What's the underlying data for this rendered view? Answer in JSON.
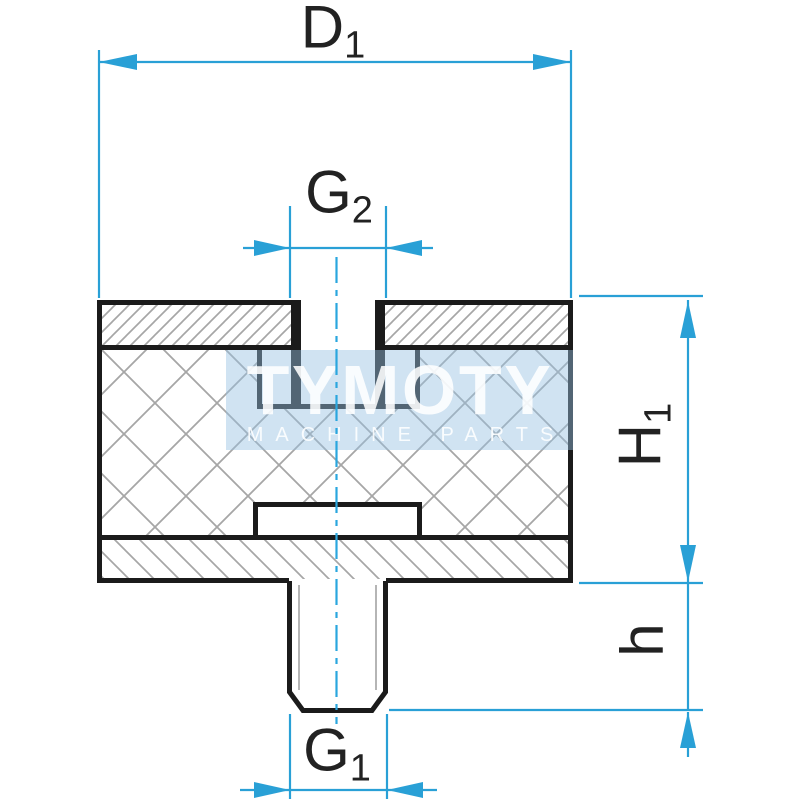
{
  "drawing": {
    "type": "technical-section-drawing",
    "part": "rubber-metal vibration mount, type plate-thread / plate-stud",
    "labels": {
      "d1": {
        "main": "D",
        "sub": "1"
      },
      "g2": {
        "main": "G",
        "sub": "2"
      },
      "h1": {
        "main": "H",
        "sub": "1"
      },
      "h": {
        "main": "h",
        "sub": ""
      },
      "g1": {
        "main": "G",
        "sub": "1"
      }
    },
    "watermark": {
      "title": "TYMOTY",
      "subtitle": "MACHINE PARTS"
    },
    "colors": {
      "dimension": "#29a0d6",
      "centerline": "#2aa6de",
      "outline": "#1b1b1b",
      "hatch": "#a6a6a6",
      "thread_line": "#b5b5b5",
      "watermark_bg": "rgba(150,193,227,0.45)",
      "watermark_text": "rgba(255,255,255,0.87)",
      "label": "#222222"
    }
  }
}
